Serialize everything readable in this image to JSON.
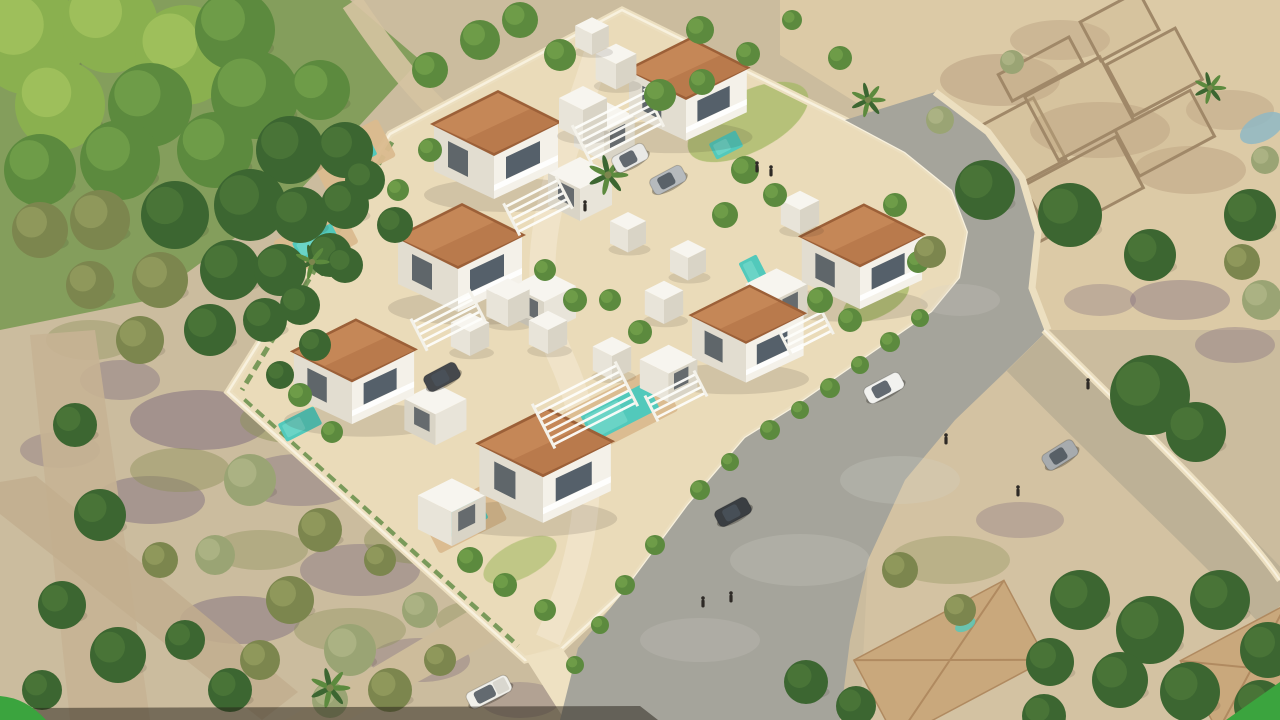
{
  "scene": {
    "type": "aerial-architectural-render",
    "subject": "walled residential development of white villas with terracotta roofs and private pools, curved access road, surrounded by scrubland, trees and existing houses"
  },
  "palette": {
    "ground": "#cbbc9e",
    "sandBright": "#dccaa6",
    "sandLow": "#d3c2a2",
    "greenZone": "#7c9a54",
    "plotFill": "#eadbb9",
    "walkway": "#f2e8cf",
    "plotWall": "#ecdfc0",
    "plotWallHi": "#f8f1de",
    "road": "#a5a49b",
    "roadDust": "#d8d5cc",
    "exitStreet": "#bdb196",
    "leftStreet": "#c6b394",
    "dirtRoad": "#c2ae8e",
    "pickupRoad": "#cdbc9b",
    "bottomWall": "#eee1c2",
    "roof": "#b97a4c",
    "roofHi": "#cf9261",
    "roofEdge": "#9c6038",
    "whiteRoof": "#f7f5ef",
    "whiteSideA": "#e8e4d9",
    "whiteSideB": "#d9d4c6",
    "wallLight": "#f4f1e9",
    "wallShade": "#e2ddd0",
    "glass": "#55606a",
    "glassDark": "#3f4850",
    "pool": "#52c9bb",
    "poolLight": "#7cdccd",
    "poolDeck": "#dabb8e",
    "pond": "#8fb9c4",
    "lawn": "#a4b964",
    "hedge": "#5e8a42",
    "treeDark": "#3c6631",
    "treeDarkHi": "#4d7a3a",
    "treeMid": "#5c8a3e",
    "treeMidHi": "#74a14c",
    "treeBright": "#8ab04f",
    "treeBrightHi": "#a4c45f",
    "treeOlive": "#7c864e",
    "treeOliveHi": "#959e60",
    "treeSage": "#9aa474",
    "treeSageHi": "#b0b788",
    "patchPurple": "#7b687c",
    "patchOlive": "#8d9159",
    "patchRubble": "#b59c7d",
    "patchSage": "#a3ad77",
    "ruinWall": "#a08868",
    "ruinFill": "#c9b28c",
    "houseRoof": "#c9a87c",
    "houseRoofLine": "#b08a60",
    "accentGreen": "#3ba43e",
    "shadowStrip": "#241d16"
  },
  "development": {
    "villas": [
      {
        "x": 494,
        "y": 135,
        "ax": 1
      },
      {
        "x": 458,
        "y": 248,
        "ax": 1
      },
      {
        "x": 352,
        "y": 362,
        "ax": 1,
        "s": 0.97
      },
      {
        "x": 543,
        "y": 455,
        "ax": -1,
        "s": 1.06
      },
      {
        "x": 686,
        "y": 80,
        "ax": -1,
        "s": 0.95
      },
      {
        "x": 860,
        "y": 247,
        "ax": -1,
        "s": 0.97
      },
      {
        "x": 746,
        "y": 325,
        "ax": -1,
        "s": 0.9
      }
    ],
    "white_cubes": [
      {
        "x": 583,
        "y": 110
      },
      {
        "x": 616,
        "y": 64,
        "s": 0.85
      },
      {
        "x": 592,
        "y": 34,
        "s": 0.7
      },
      {
        "x": 508,
        "y": 300,
        "s": 0.9
      },
      {
        "x": 548,
        "y": 330,
        "s": 0.8
      },
      {
        "x": 612,
        "y": 356,
        "s": 0.8
      },
      {
        "x": 664,
        "y": 300,
        "s": 0.8
      },
      {
        "x": 688,
        "y": 258,
        "s": 0.75
      },
      {
        "x": 470,
        "y": 332,
        "s": 0.8
      },
      {
        "x": 628,
        "y": 230,
        "s": 0.75
      },
      {
        "x": 800,
        "y": 210,
        "s": 0.8
      }
    ],
    "pools": [
      {
        "x": 352,
        "y": 155,
        "w": 46,
        "h": 22,
        "deck": true
      },
      {
        "x": 316,
        "y": 242,
        "w": 44,
        "h": 20,
        "deck": true
      },
      {
        "x": 300,
        "y": 424,
        "w": 40,
        "h": 20
      },
      {
        "x": 464,
        "y": 518,
        "w": 44,
        "h": 22,
        "deck": true
      },
      {
        "x": 620,
        "y": 412,
        "w": 74,
        "h": 30,
        "deck": true
      },
      {
        "x": 755,
        "y": 274,
        "w": 20,
        "h": 34
      },
      {
        "x": 726,
        "y": 145,
        "w": 30,
        "h": 18
      }
    ],
    "pergolas": [
      {
        "x": 585,
        "y": 405,
        "l": 92,
        "n": 7
      },
      {
        "x": 618,
        "y": 126,
        "l": 80,
        "n": 6
      },
      {
        "x": 448,
        "y": 320,
        "l": 64,
        "n": 5
      },
      {
        "x": 538,
        "y": 206,
        "l": 58,
        "n": 5
      },
      {
        "x": 676,
        "y": 396,
        "l": 54,
        "n": 4
      },
      {
        "x": 806,
        "y": 332,
        "l": 46,
        "n": 4
      }
    ]
  },
  "vehicles": [
    {
      "t": "suv",
      "c": "#f2f2ef",
      "x": 884,
      "y": 388,
      "a": -28
    },
    {
      "t": "car",
      "c": "#3a3e42",
      "x": 733,
      "y": 512,
      "a": -28
    },
    {
      "t": "car",
      "c": "#a7abae",
      "x": 1060,
      "y": 455,
      "a": -32
    },
    {
      "t": "pickup",
      "c": "#f1f0ea",
      "x": 489,
      "y": 692,
      "a": -27
    },
    {
      "t": "car",
      "c": "#e9e9e6",
      "x": 630,
      "y": 158,
      "a": -28
    },
    {
      "t": "car",
      "c": "#b6babd",
      "x": 668,
      "y": 180,
      "a": -28
    },
    {
      "t": "car",
      "c": "#45484c",
      "x": 442,
      "y": 377,
      "a": -28
    }
  ],
  "people": [
    [
      757,
      168
    ],
    [
      771,
      172
    ],
    [
      946,
      440
    ],
    [
      731,
      598
    ],
    [
      1018,
      492
    ],
    [
      703,
      603
    ],
    [
      1088,
      385
    ],
    [
      585,
      207
    ]
  ],
  "vegetation": {
    "trees": [
      [
        30,
        40,
        55,
        "b"
      ],
      [
        110,
        25,
        48,
        "b"
      ],
      [
        185,
        55,
        50,
        "b"
      ],
      [
        60,
        105,
        45,
        "b"
      ],
      [
        150,
        105,
        42,
        "m"
      ],
      [
        235,
        30,
        40,
        "m"
      ],
      [
        255,
        95,
        44,
        "m"
      ],
      [
        215,
        150,
        38,
        "m"
      ],
      [
        120,
        160,
        40,
        "m"
      ],
      [
        40,
        170,
        36,
        "m"
      ],
      [
        290,
        150,
        34,
        "d"
      ],
      [
        320,
        90,
        30,
        "m"
      ],
      [
        345,
        150,
        28,
        "d"
      ],
      [
        250,
        205,
        36,
        "d"
      ],
      [
        175,
        215,
        34,
        "d"
      ],
      [
        100,
        220,
        30,
        "o"
      ],
      [
        40,
        230,
        28,
        "o"
      ],
      [
        300,
        215,
        28,
        "d"
      ],
      [
        345,
        205,
        24,
        "d"
      ],
      [
        230,
        270,
        30,
        "d"
      ],
      [
        160,
        280,
        28,
        "o"
      ],
      [
        90,
        285,
        24,
        "o"
      ],
      [
        280,
        270,
        26,
        "d"
      ],
      [
        330,
        255,
        22,
        "d"
      ],
      [
        210,
        330,
        26,
        "d"
      ],
      [
        140,
        340,
        24,
        "o"
      ],
      [
        265,
        320,
        22,
        "d"
      ],
      [
        300,
        305,
        20,
        "d"
      ],
      [
        365,
        180,
        20,
        "d"
      ],
      [
        395,
        225,
        18,
        "d"
      ],
      [
        345,
        265,
        18,
        "d"
      ],
      [
        315,
        345,
        16,
        "d"
      ],
      [
        280,
        375,
        14,
        "d"
      ],
      [
        75,
        425,
        22,
        "d"
      ],
      [
        100,
        515,
        26,
        "d"
      ],
      [
        62,
        605,
        24,
        "d"
      ],
      [
        118,
        655,
        28,
        "d"
      ],
      [
        42,
        690,
        20,
        "d"
      ],
      [
        160,
        560,
        18,
        "o"
      ],
      [
        185,
        640,
        20,
        "d"
      ],
      [
        230,
        690,
        22,
        "d"
      ],
      [
        250,
        480,
        26,
        "s"
      ],
      [
        320,
        530,
        22,
        "o"
      ],
      [
        215,
        555,
        20,
        "s"
      ],
      [
        290,
        600,
        24,
        "o"
      ],
      [
        350,
        650,
        26,
        "s"
      ],
      [
        260,
        660,
        20,
        "o"
      ],
      [
        390,
        690,
        22,
        "o"
      ],
      [
        330,
        700,
        18,
        "s"
      ],
      [
        420,
        610,
        18,
        "s"
      ],
      [
        380,
        560,
        16,
        "o"
      ],
      [
        440,
        660,
        16,
        "o"
      ],
      [
        480,
        40,
        20,
        "m"
      ],
      [
        520,
        20,
        18,
        "m"
      ],
      [
        560,
        55,
        16,
        "m"
      ],
      [
        430,
        70,
        18,
        "m"
      ],
      [
        700,
        30,
        14,
        "m"
      ],
      [
        748,
        54,
        12,
        "m"
      ],
      [
        792,
        20,
        10,
        "m"
      ],
      [
        840,
        58,
        12,
        "m"
      ],
      [
        660,
        95,
        16,
        "m"
      ],
      [
        702,
        82,
        13,
        "m"
      ],
      [
        745,
        170,
        14,
        "m"
      ],
      [
        775,
        195,
        12,
        "m"
      ],
      [
        725,
        215,
        13,
        "m"
      ],
      [
        820,
        300,
        13,
        "m"
      ],
      [
        850,
        320,
        12,
        "m"
      ],
      [
        640,
        332,
        12,
        "m"
      ],
      [
        610,
        300,
        11,
        "m"
      ],
      [
        430,
        150,
        12,
        "m"
      ],
      [
        398,
        190,
        11,
        "m"
      ],
      [
        300,
        395,
        12,
        "m"
      ],
      [
        332,
        432,
        11,
        "m"
      ],
      [
        470,
        560,
        13,
        "m"
      ],
      [
        505,
        585,
        12,
        "m"
      ],
      [
        545,
        610,
        11,
        "m"
      ],
      [
        575,
        300,
        12,
        "m"
      ],
      [
        545,
        270,
        11,
        "m"
      ],
      [
        895,
        205,
        12,
        "m"
      ],
      [
        918,
        262,
        11,
        "m"
      ],
      [
        770,
        430,
        10,
        "m"
      ],
      [
        800,
        410,
        9,
        "m"
      ],
      [
        830,
        388,
        10,
        "m"
      ],
      [
        860,
        365,
        9,
        "m"
      ],
      [
        890,
        342,
        10,
        "m"
      ],
      [
        920,
        318,
        9,
        "m"
      ],
      [
        655,
        545,
        10,
        "m"
      ],
      [
        625,
        585,
        10,
        "m"
      ],
      [
        600,
        625,
        9,
        "m"
      ],
      [
        700,
        490,
        10,
        "m"
      ],
      [
        730,
        462,
        9,
        "m"
      ],
      [
        575,
        665,
        9,
        "m"
      ],
      [
        985,
        190,
        30,
        "d"
      ],
      [
        1070,
        215,
        32,
        "d"
      ],
      [
        1150,
        255,
        26,
        "d"
      ],
      [
        1250,
        215,
        26,
        "d"
      ],
      [
        940,
        120,
        14,
        "s"
      ],
      [
        1012,
        62,
        12,
        "s"
      ],
      [
        930,
        252,
        16,
        "o"
      ],
      [
        1242,
        262,
        18,
        "o"
      ],
      [
        1265,
        160,
        14,
        "s"
      ],
      [
        1150,
        395,
        40,
        "d"
      ],
      [
        1196,
        432,
        30,
        "d"
      ],
      [
        1262,
        300,
        20,
        "s"
      ],
      [
        1080,
        600,
        30,
        "d"
      ],
      [
        1150,
        630,
        34,
        "d"
      ],
      [
        1220,
        600,
        30,
        "d"
      ],
      [
        1268,
        650,
        28,
        "d"
      ],
      [
        1120,
        680,
        28,
        "d"
      ],
      [
        1190,
        692,
        30,
        "d"
      ],
      [
        1260,
        706,
        26,
        "d"
      ],
      [
        1050,
        662,
        24,
        "d"
      ],
      [
        1044,
        716,
        22,
        "d"
      ],
      [
        806,
        682,
        22,
        "d"
      ],
      [
        856,
        706,
        20,
        "d"
      ],
      [
        900,
        570,
        18,
        "o"
      ],
      [
        960,
        610,
        16,
        "o"
      ]
    ],
    "palms": [
      [
        608,
        175,
        30
      ],
      [
        312,
        262,
        26
      ],
      [
        330,
        688,
        30
      ],
      [
        868,
        100,
        26
      ],
      [
        1210,
        88,
        24
      ]
    ]
  },
  "terrain": {
    "patches": [
      [
        200,
        420,
        70,
        30,
        "p",
        0.5
      ],
      [
        300,
        480,
        60,
        26,
        "p",
        0.4
      ],
      [
        150,
        500,
        55,
        24,
        "p",
        0.45
      ],
      [
        360,
        570,
        60,
        26,
        "p",
        0.4
      ],
      [
        240,
        620,
        60,
        24,
        "p",
        0.45
      ],
      [
        420,
        660,
        50,
        22,
        "p",
        0.35
      ],
      [
        120,
        380,
        40,
        20,
        "p",
        0.4
      ],
      [
        520,
        700,
        40,
        18,
        "p",
        0.3
      ],
      [
        1180,
        300,
        50,
        20,
        "p",
        0.4
      ],
      [
        1235,
        345,
        40,
        18,
        "p",
        0.35
      ],
      [
        1100,
        300,
        36,
        16,
        "p",
        0.3
      ],
      [
        300,
        420,
        60,
        24,
        "o",
        0.5
      ],
      [
        420,
        540,
        56,
        24,
        "o",
        0.5
      ],
      [
        180,
        470,
        50,
        22,
        "o",
        0.45
      ],
      [
        350,
        630,
        56,
        22,
        "o",
        0.4
      ],
      [
        480,
        620,
        44,
        20,
        "o",
        0.4
      ],
      [
        260,
        550,
        48,
        20,
        "o",
        0.4
      ],
      [
        1000,
        80,
        60,
        26,
        "r",
        0.5
      ],
      [
        1100,
        130,
        70,
        28,
        "r",
        0.5
      ],
      [
        1190,
        170,
        56,
        24,
        "r",
        0.45
      ],
      [
        960,
        160,
        50,
        22,
        "r",
        0.4
      ],
      [
        1060,
        40,
        50,
        20,
        "r",
        0.4
      ],
      [
        1230,
        110,
        44,
        20,
        "r",
        0.4
      ],
      [
        950,
        560,
        60,
        24,
        "o",
        0.35
      ],
      [
        1020,
        520,
        44,
        18,
        "p",
        0.3
      ],
      [
        90,
        340,
        44,
        20,
        "o",
        0.4
      ],
      [
        60,
        450,
        40,
        18,
        "p",
        0.35
      ]
    ]
  },
  "ruins": {
    "rooms": [
      [
        960,
        75,
        95,
        70
      ],
      [
        1048,
        70,
        85,
        72
      ],
      [
        1135,
        80,
        78,
        58
      ],
      [
        1005,
        148,
        105,
        58
      ],
      [
        1112,
        142,
        85,
        52
      ],
      [
        952,
        150,
        50,
        55
      ],
      [
        1035,
        38,
        80,
        30
      ],
      [
        1132,
        30,
        66,
        44
      ]
    ]
  },
  "overlay": {
    "corner_accent_color": "#3ba43e",
    "corners": [
      "bottom-left",
      "bottom-right"
    ]
  }
}
